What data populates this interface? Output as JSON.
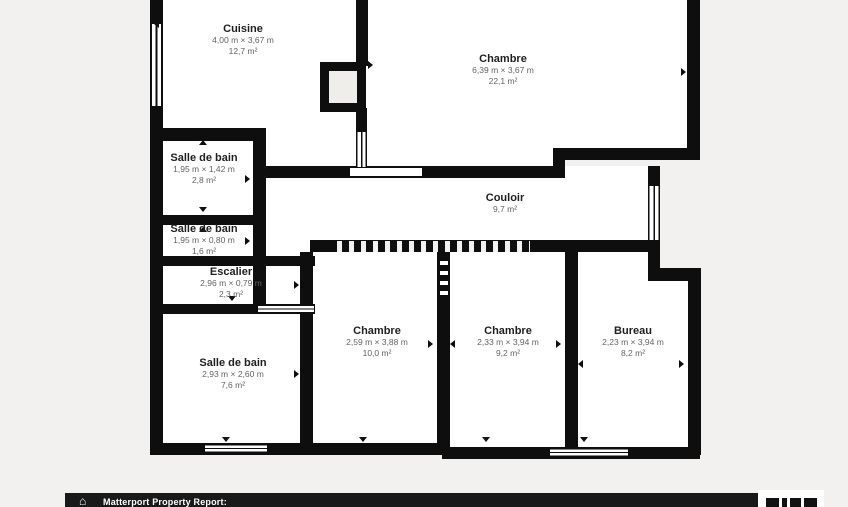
{
  "meta": {
    "document_type": "floor-plan",
    "colors": {
      "background": "#f2f1ef",
      "wall": "#0e0e0e",
      "room_fill": "#ffffff",
      "room_name_text": "#1f1f1f",
      "room_detail_text": "#636363",
      "footer_bg": "#191919",
      "footer_text": "#ffffff"
    }
  },
  "rooms": [
    {
      "id": "cuisine",
      "name": "Cuisine",
      "dimensions": "4,00 m × 3,67 m",
      "area": "12,7 m²"
    },
    {
      "id": "chambre-top",
      "name": "Chambre",
      "dimensions": "6,39 m × 3,67 m",
      "area": "22,1 m²"
    },
    {
      "id": "salle-de-bain-1",
      "name": "Salle de bain",
      "dimensions": "1,95 m × 1,42 m",
      "area": "2,8 m²"
    },
    {
      "id": "salle-de-bain-2",
      "name": "Salle de bain",
      "dimensions": "1,95 m × 0,80 m",
      "area": "1,6 m²"
    },
    {
      "id": "couloir",
      "name": "Couloir",
      "dimensions": "",
      "area": "9,7 m²"
    },
    {
      "id": "escalier",
      "name": "Escalier",
      "dimensions": "2,96 m × 0,79 m",
      "area": "2,3 m²"
    },
    {
      "id": "salle-de-bain-3",
      "name": "Salle de bain",
      "dimensions": "2,93 m × 2,60 m",
      "area": "7,6 m²"
    },
    {
      "id": "chambre-bottom-left",
      "name": "Chambre",
      "dimensions": "2,59 m × 3,88 m",
      "area": "10,0 m²"
    },
    {
      "id": "chambre-bottom-right",
      "name": "Chambre",
      "dimensions": "2,33 m × 3,94 m",
      "area": "9,2 m²"
    },
    {
      "id": "bureau",
      "name": "Bureau",
      "dimensions": "2,23 m × 3,94 m",
      "area": "8,2 m²"
    }
  ],
  "footer": {
    "label": "Matterport Property Report:",
    "home_glyph": "⌂"
  }
}
